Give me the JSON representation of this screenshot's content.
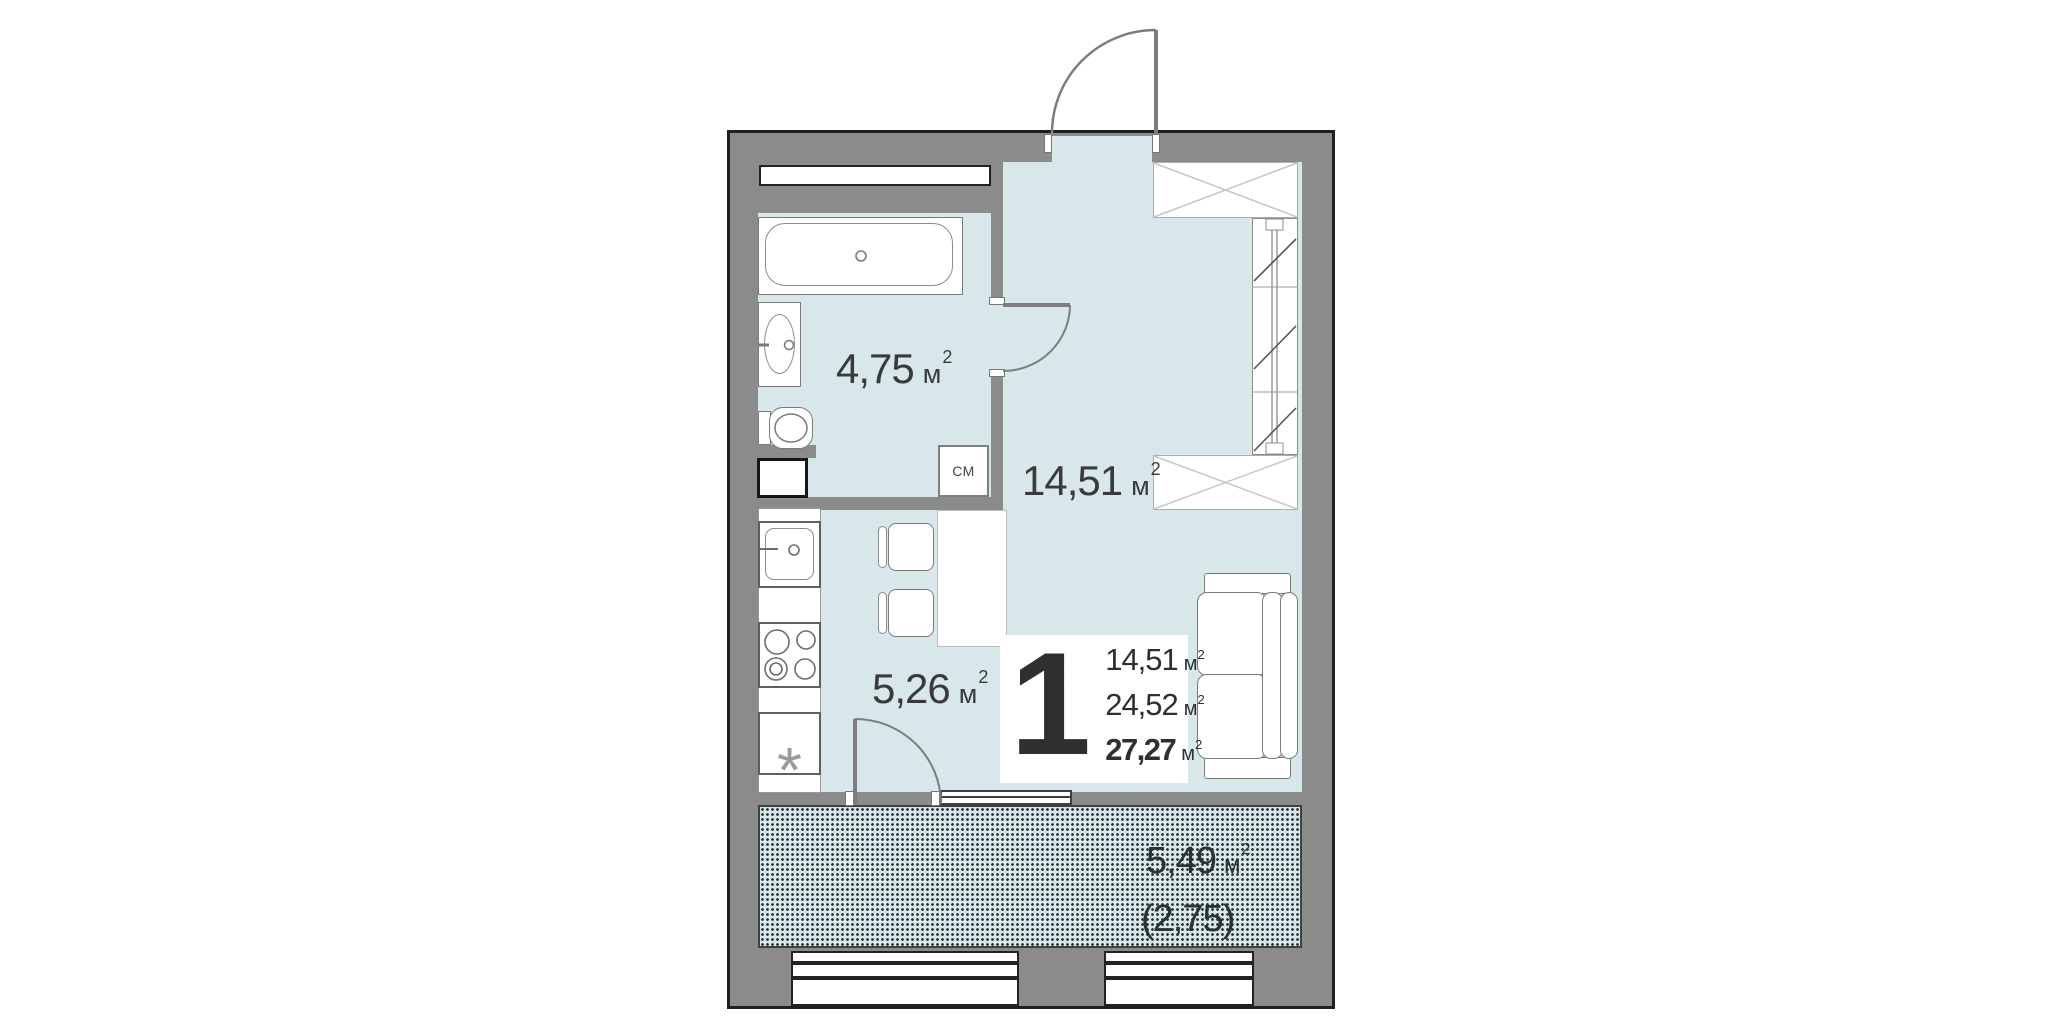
{
  "apartment": {
    "number": "1",
    "area_rows": [
      {
        "value": "14,51",
        "unit": "м",
        "sup": "2"
      },
      {
        "value": "24,52",
        "unit": "м",
        "sup": "2"
      },
      {
        "value": "27,27",
        "unit": "м",
        "sup": "2"
      }
    ]
  },
  "room_labels": {
    "bathroom": {
      "value": "4,75",
      "unit": "м",
      "sup": "2"
    },
    "kitchen": {
      "value": "5,26",
      "unit": "м",
      "sup": "2"
    },
    "living": {
      "value": "14,51",
      "unit": "м",
      "sup": "2"
    },
    "balcony": {
      "value": "5,49",
      "unit": "м",
      "sup": "2"
    },
    "balcony_coefficient": {
      "value": "(2,75)"
    }
  },
  "appliance_labels": {
    "washing_machine": "СМ",
    "star": "*"
  },
  "colors": {
    "wall": "#8b8b8b",
    "floor": "#d8e8ea",
    "outline": "#1f1f1f",
    "text": "#3a3a3a"
  }
}
